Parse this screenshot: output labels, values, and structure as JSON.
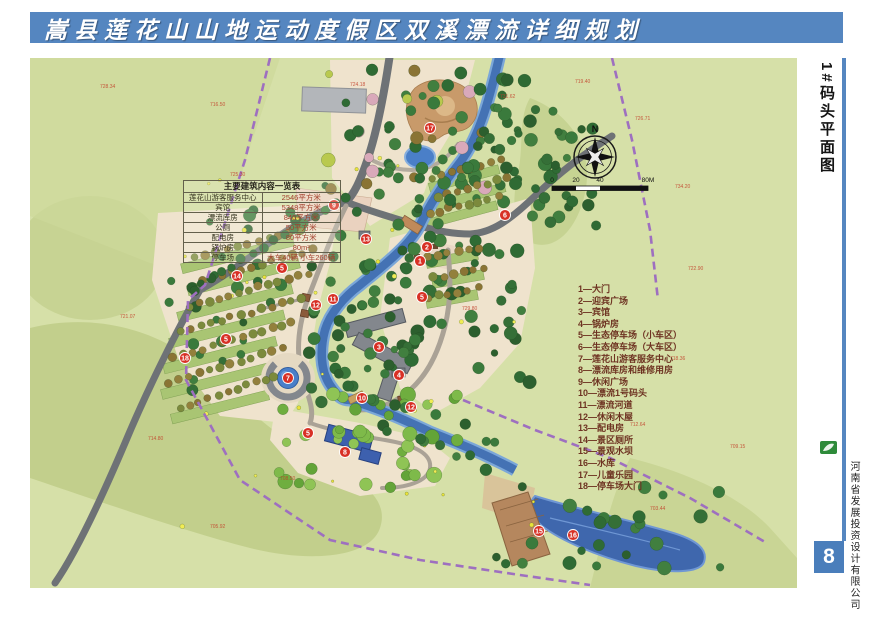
{
  "title": {
    "text": "嵩县莲花山山地运动度假区双溪漂流详细规划"
  },
  "sidebar": {
    "plan_label": "1#码头平面图",
    "company": "河南省发展投资设计有限公司",
    "page_number": "8",
    "logo_icon": "green-leaf-logo"
  },
  "building_table": {
    "title": "主要建筑内容一览表",
    "rows": [
      {
        "name": "莲花山游客服务中心",
        "value": "2546平方米"
      },
      {
        "name": "宾馆",
        "value": "5348平方米"
      },
      {
        "name": "漂流库房",
        "value": "840平方米"
      },
      {
        "name": "公厕",
        "value": "50平方米"
      },
      {
        "name": "配电房",
        "value": "80平方米"
      },
      {
        "name": "锅炉房",
        "value": "80m²"
      },
      {
        "name": "停车场",
        "value": "大车40辆 小车260辆"
      }
    ]
  },
  "legend": {
    "items": [
      "1—大门",
      "2—迎宾广场",
      "3—宾馆",
      "4—锅炉房",
      "5—生态停车场（小车区）",
      "6—生态停车场（大车区）",
      "7—莲花山游客服务中心",
      "8—漂流库房和维修用房",
      "9—休闲广场",
      "10—漂流1号码头",
      "11—漂流河道",
      "12—休闲木屋",
      "13—配电房",
      "14—景区厕所",
      "15—景观水坝",
      "16—水库",
      "17—儿童乐园",
      "18—停车场大门"
    ]
  },
  "compass": {
    "north_label": "N"
  },
  "scale_bar": {
    "labels": [
      "0",
      "20",
      "40",
      "80M"
    ]
  },
  "markers": [
    {
      "n": "17",
      "x": 400,
      "y": 70
    },
    {
      "n": "9",
      "x": 304,
      "y": 147
    },
    {
      "n": "13",
      "x": 336,
      "y": 181
    },
    {
      "n": "2",
      "x": 397,
      "y": 189
    },
    {
      "n": "1",
      "x": 390,
      "y": 203
    },
    {
      "n": "6",
      "x": 475,
      "y": 157
    },
    {
      "n": "14",
      "x": 207,
      "y": 218
    },
    {
      "n": "5",
      "x": 252,
      "y": 210
    },
    {
      "n": "5",
      "x": 196,
      "y": 281
    },
    {
      "n": "5",
      "x": 392,
      "y": 239
    },
    {
      "n": "11",
      "x": 303,
      "y": 241
    },
    {
      "n": "12",
      "x": 286,
      "y": 247
    },
    {
      "n": "18",
      "x": 155,
      "y": 300
    },
    {
      "n": "3",
      "x": 349,
      "y": 289
    },
    {
      "n": "4",
      "x": 369,
      "y": 317
    },
    {
      "n": "7",
      "x": 258,
      "y": 320
    },
    {
      "n": "10",
      "x": 332,
      "y": 340
    },
    {
      "n": "12",
      "x": 381,
      "y": 349
    },
    {
      "n": "5",
      "x": 278,
      "y": 375
    },
    {
      "n": "8",
      "x": 315,
      "y": 394
    },
    {
      "n": "15",
      "x": 509,
      "y": 473
    },
    {
      "n": "16",
      "x": 543,
      "y": 477
    }
  ],
  "elevations": [
    {
      "v": "728.34",
      "x": 70,
      "y": 30
    },
    {
      "v": "716.50",
      "x": 180,
      "y": 48
    },
    {
      "v": "724.18",
      "x": 320,
      "y": 28
    },
    {
      "v": "731.62",
      "x": 470,
      "y": 40
    },
    {
      "v": "719.40",
      "x": 545,
      "y": 25
    },
    {
      "v": "726.71",
      "x": 605,
      "y": 62
    },
    {
      "v": "734.20",
      "x": 645,
      "y": 130
    },
    {
      "v": "722.90",
      "x": 658,
      "y": 212
    },
    {
      "v": "718.36",
      "x": 640,
      "y": 302
    },
    {
      "v": "712.64",
      "x": 600,
      "y": 368
    },
    {
      "v": "708.50",
      "x": 250,
      "y": 422
    },
    {
      "v": "705.92",
      "x": 180,
      "y": 470
    },
    {
      "v": "714.80",
      "x": 118,
      "y": 382
    },
    {
      "v": "721.07",
      "x": 90,
      "y": 260
    },
    {
      "v": "725.30",
      "x": 200,
      "y": 118
    },
    {
      "v": "729.80",
      "x": 432,
      "y": 252
    },
    {
      "v": "703.44",
      "x": 620,
      "y": 452
    },
    {
      "v": "709.15",
      "x": 700,
      "y": 390
    }
  ],
  "colors": {
    "title_bar": "#5586c0",
    "accent_blue": "#4a7ebb",
    "map_background": "#d6e0a8",
    "river": "#4472b4",
    "boundary_dashed": "#9e6fc0",
    "marker_red": "#d83025",
    "road_gray": "#6e7276"
  }
}
